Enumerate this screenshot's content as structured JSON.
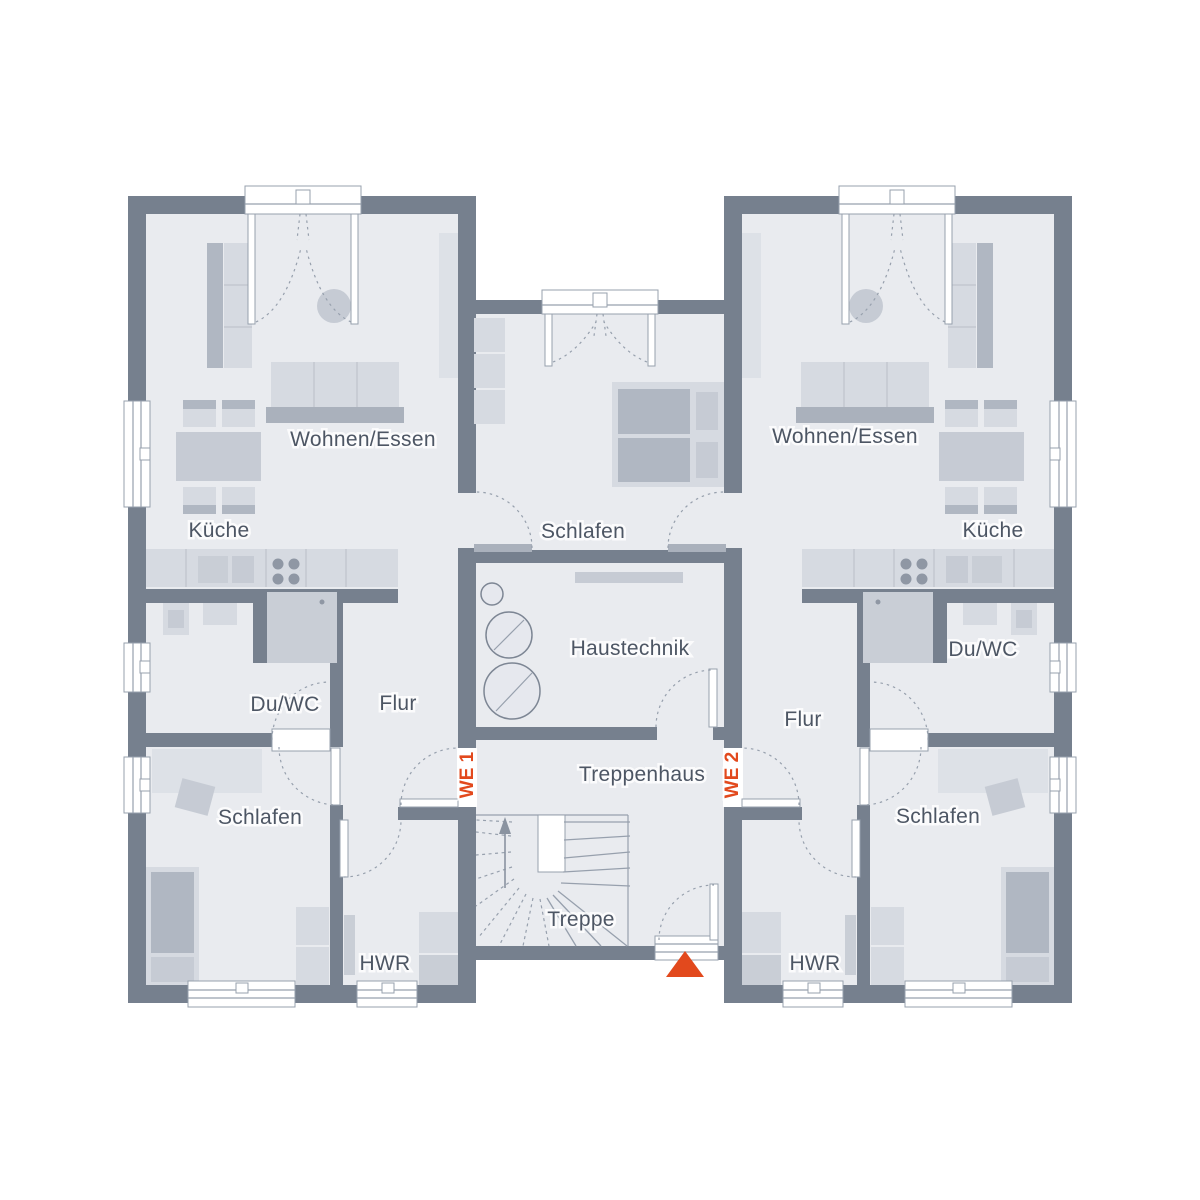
{
  "plan": {
    "unit1": {
      "marker": "WE 1",
      "rooms": {
        "wohnen_essen": "Wohnen/Essen",
        "kueche": "Küche",
        "du_wc": "Du/WC",
        "flur": "Flur",
        "schlafen": "Schlafen",
        "hwr": "HWR"
      }
    },
    "unit2": {
      "marker": "WE 2",
      "rooms": {
        "wohnen_essen": "Wohnen/Essen",
        "kueche": "Küche",
        "du_wc": "Du/WC",
        "flur": "Flur",
        "schlafen": "Schlafen",
        "hwr": "HWR"
      }
    },
    "core": {
      "schlafen": "Schlafen",
      "haustechnik": "Haustechnik",
      "treppenhaus": "Treppenhaus",
      "treppe": "Treppe"
    }
  },
  "colors": {
    "wall": "#76808e",
    "floor": "#e9ebef",
    "furnitureLight": "#d6dae1",
    "furnitureMid": "#c6cbd4",
    "furnitureDark": "#b0b7c2",
    "accent": "#e2491d",
    "label": "#4d5664",
    "line": "#97a0ad"
  }
}
